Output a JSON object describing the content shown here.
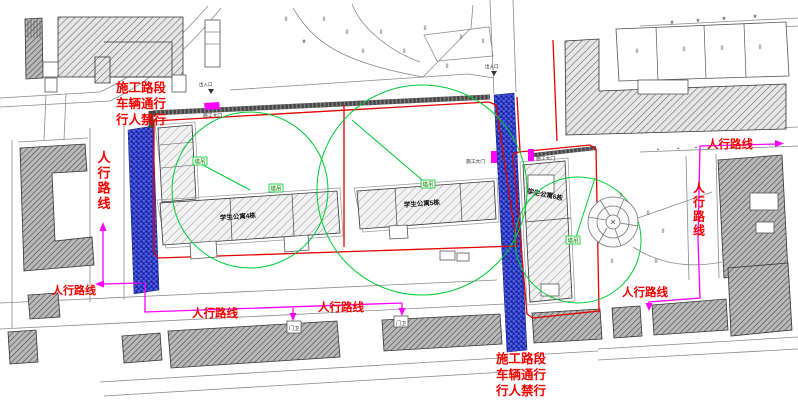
{
  "colors": {
    "annotation_red": "#f40000",
    "boundary_red": "#e60000",
    "route_magenta": "#ff00ff",
    "crane_green": "#00cc33",
    "road_blue": "#2e3ec8"
  },
  "labels": {
    "closure": [
      "施工路段",
      "车辆通行",
      "行人禁行"
    ],
    "pedestrian_route": "人行路线",
    "construction_gate": "施工大门",
    "tower_crane": "塔吊",
    "guard": "门卫",
    "entrance": "出入口"
  },
  "buildings": {
    "left": "学生公寓4栋",
    "middle": "学生公寓5栋",
    "right": "学生公寓6栋"
  },
  "scatter": {
    "grass": {
      "glyph": "II",
      "size": 6,
      "color": "#666666",
      "positions": [
        [
          286,
          21
        ],
        [
          324,
          21
        ],
        [
          347,
          34
        ],
        [
          363,
          53
        ],
        [
          381,
          34
        ],
        [
          404,
          53
        ],
        [
          425,
          30
        ],
        [
          447,
          68
        ],
        [
          461,
          39
        ],
        [
          483,
          43
        ],
        [
          637,
          53
        ],
        [
          684,
          51
        ],
        [
          722,
          50
        ],
        [
          760,
          49
        ],
        [
          621,
          197
        ],
        [
          648,
          215
        ],
        [
          663,
          233
        ],
        [
          612,
          263
        ],
        [
          656,
          263
        ],
        [
          700,
          235
        ]
      ]
    },
    "trees": {
      "glyph": "*",
      "size": 9,
      "color": "#2a2a2a",
      "positions": [
        [
          672,
          27
        ],
        [
          698,
          25
        ],
        [
          724,
          23
        ],
        [
          755,
          21
        ],
        [
          304,
          46
        ]
      ]
    },
    "bollards": {
      "glyph": "▪",
      "size": 5,
      "color": "#333333",
      "positions": [
        [
          658,
          151
        ],
        [
          678,
          150
        ],
        [
          696,
          149
        ]
      ]
    }
  }
}
